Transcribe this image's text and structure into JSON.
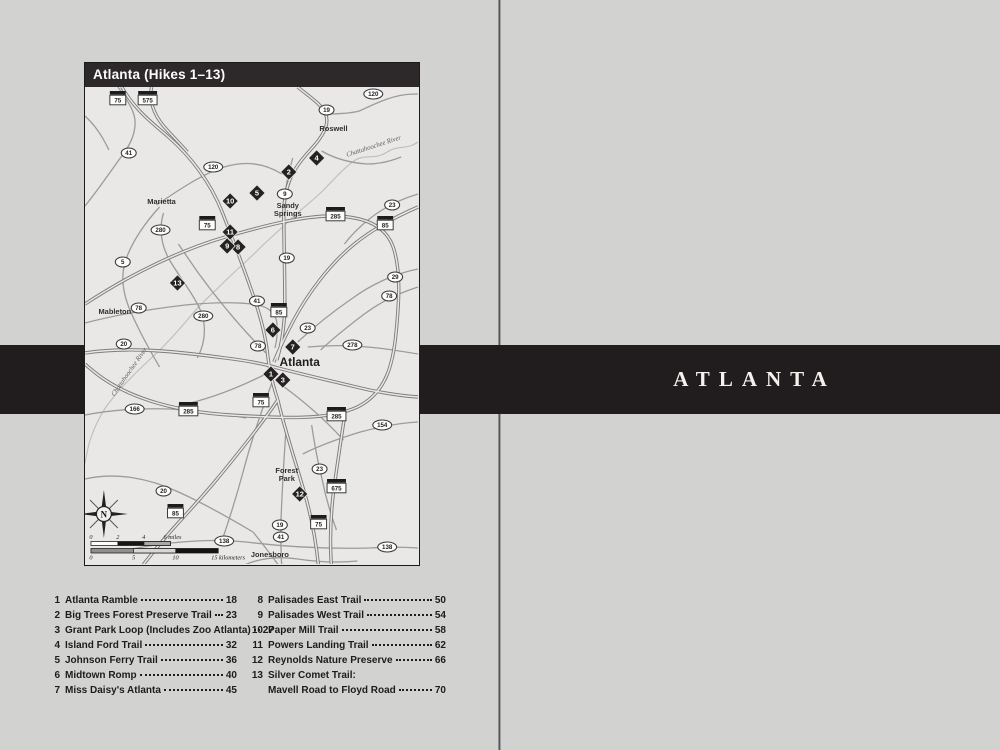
{
  "divider": {
    "title": "ATLANTA"
  },
  "map": {
    "title": "Atlanta (Hikes 1–13)",
    "cities": [
      {
        "name": "Roswell",
        "x": 334,
        "y": 130
      },
      {
        "name": "Marietta",
        "x": 161,
        "y": 203
      },
      {
        "lines": [
          "Sandy",
          "Springs"
        ],
        "x": 288,
        "y": 207
      },
      {
        "name": "Mableton",
        "x": 114,
        "y": 313
      },
      {
        "name": "Atlanta",
        "x": 300,
        "y": 365,
        "major": true
      },
      {
        "lines": [
          "Forest",
          "Park"
        ],
        "x": 287,
        "y": 472
      },
      {
        "name": "Jonesboro",
        "x": 270,
        "y": 556
      }
    ],
    "rivers": [
      {
        "name": "Chattahoochee River",
        "x": 375,
        "y": 147,
        "angle": -18
      },
      {
        "name": "Chattahoochee River",
        "x": 130,
        "y": 372,
        "angle": -55
      }
    ],
    "interstates": [
      {
        "num": "75",
        "x": 117,
        "y": 99
      },
      {
        "num": "575",
        "x": 147,
        "y": 99
      },
      {
        "num": "75",
        "x": 207,
        "y": 224
      },
      {
        "num": "285",
        "x": 336,
        "y": 215
      },
      {
        "num": "85",
        "x": 386,
        "y": 224
      },
      {
        "num": "85",
        "x": 279,
        "y": 311
      },
      {
        "num": "75",
        "x": 261,
        "y": 401
      },
      {
        "num": "285",
        "x": 188,
        "y": 410
      },
      {
        "num": "285",
        "x": 337,
        "y": 415
      },
      {
        "num": "85",
        "x": 175,
        "y": 512
      },
      {
        "num": "675",
        "x": 337,
        "y": 487
      },
      {
        "num": "75",
        "x": 319,
        "y": 523
      }
    ],
    "routes": [
      {
        "num": "41",
        "x": 128,
        "y": 152
      },
      {
        "num": "120",
        "x": 213,
        "y": 166
      },
      {
        "num": "120",
        "x": 374,
        "y": 93
      },
      {
        "num": "19",
        "x": 327,
        "y": 109
      },
      {
        "num": "9",
        "x": 285,
        "y": 193
      },
      {
        "num": "23",
        "x": 393,
        "y": 204
      },
      {
        "num": "280",
        "x": 160,
        "y": 229
      },
      {
        "num": "5",
        "x": 122,
        "y": 261
      },
      {
        "num": "78",
        "x": 138,
        "y": 307
      },
      {
        "num": "280",
        "x": 203,
        "y": 315
      },
      {
        "num": "19",
        "x": 287,
        "y": 257
      },
      {
        "num": "29",
        "x": 396,
        "y": 276
      },
      {
        "num": "78",
        "x": 390,
        "y": 295
      },
      {
        "num": "41",
        "x": 257,
        "y": 300
      },
      {
        "num": "23",
        "x": 308,
        "y": 327
      },
      {
        "num": "78",
        "x": 258,
        "y": 345
      },
      {
        "num": "278",
        "x": 353,
        "y": 344
      },
      {
        "num": "20",
        "x": 123,
        "y": 343
      },
      {
        "num": "166",
        "x": 134,
        "y": 408
      },
      {
        "num": "154",
        "x": 383,
        "y": 424
      },
      {
        "num": "20",
        "x": 163,
        "y": 490
      },
      {
        "num": "23",
        "x": 320,
        "y": 468
      },
      {
        "num": "19",
        "x": 280,
        "y": 524
      },
      {
        "num": "41",
        "x": 281,
        "y": 536
      },
      {
        "num": "138",
        "x": 224,
        "y": 540
      },
      {
        "num": "138",
        "x": 388,
        "y": 546
      }
    ],
    "markers": [
      {
        "num": "1",
        "x": 271,
        "y": 373
      },
      {
        "num": "2",
        "x": 289,
        "y": 171
      },
      {
        "num": "3",
        "x": 283,
        "y": 379
      },
      {
        "num": "4",
        "x": 317,
        "y": 157
      },
      {
        "num": "5",
        "x": 257,
        "y": 192
      },
      {
        "num": "6",
        "x": 273,
        "y": 329
      },
      {
        "num": "7",
        "x": 293,
        "y": 346
      },
      {
        "num": "8",
        "x": 238,
        "y": 246
      },
      {
        "num": "9",
        "x": 227,
        "y": 245
      },
      {
        "num": "10",
        "x": 230,
        "y": 200
      },
      {
        "num": "11",
        "x": 230,
        "y": 231
      },
      {
        "num": "12",
        "x": 300,
        "y": 493
      },
      {
        "num": "13",
        "x": 177,
        "y": 282
      }
    ],
    "compass": {
      "label": "N"
    },
    "scale": {
      "miles_ticks": [
        {
          "label": "0",
          "x": 90
        },
        {
          "label": "2",
          "x": 117
        },
        {
          "label": "4",
          "x": 143
        },
        {
          "label": "6 miles",
          "x": 172
        }
      ],
      "km_ticks": [
        {
          "label": "0",
          "x": 90
        },
        {
          "label": "5",
          "x": 133
        },
        {
          "label": "10",
          "x": 175
        },
        {
          "label": "15 kilometers",
          "x": 228
        }
      ]
    }
  },
  "toc": {
    "left": [
      {
        "num": "1",
        "title": "Atlanta Ramble",
        "page": "18"
      },
      {
        "num": "2",
        "title": "Big Trees Forest Preserve Trail",
        "page": "23"
      },
      {
        "num": "3",
        "title": "Grant Park Loop (Includes Zoo Atlanta)",
        "page": "27"
      },
      {
        "num": "4",
        "title": "Island Ford Trail",
        "page": "32"
      },
      {
        "num": "5",
        "title": "Johnson Ferry Trail",
        "page": "36"
      },
      {
        "num": "6",
        "title": "Midtown Romp",
        "page": "40"
      },
      {
        "num": "7",
        "title": "Miss Daisy's Atlanta",
        "page": "45"
      }
    ],
    "right": [
      {
        "num": "8",
        "title": "Palisades East Trail",
        "page": "50"
      },
      {
        "num": "9",
        "title": "Palisades West Trail",
        "page": "54"
      },
      {
        "num": "10",
        "title": "Paper Mill Trail",
        "page": "58"
      },
      {
        "num": "11",
        "title": "Powers Landing Trail",
        "page": "62"
      },
      {
        "num": "12",
        "title": "Reynolds Nature Preserve",
        "page": "66"
      },
      {
        "num": "13",
        "title": "Silver Comet Trail:",
        "page": null
      },
      {
        "num": "",
        "title": "Mavell Road to Floyd Road",
        "page": "70"
      }
    ]
  }
}
